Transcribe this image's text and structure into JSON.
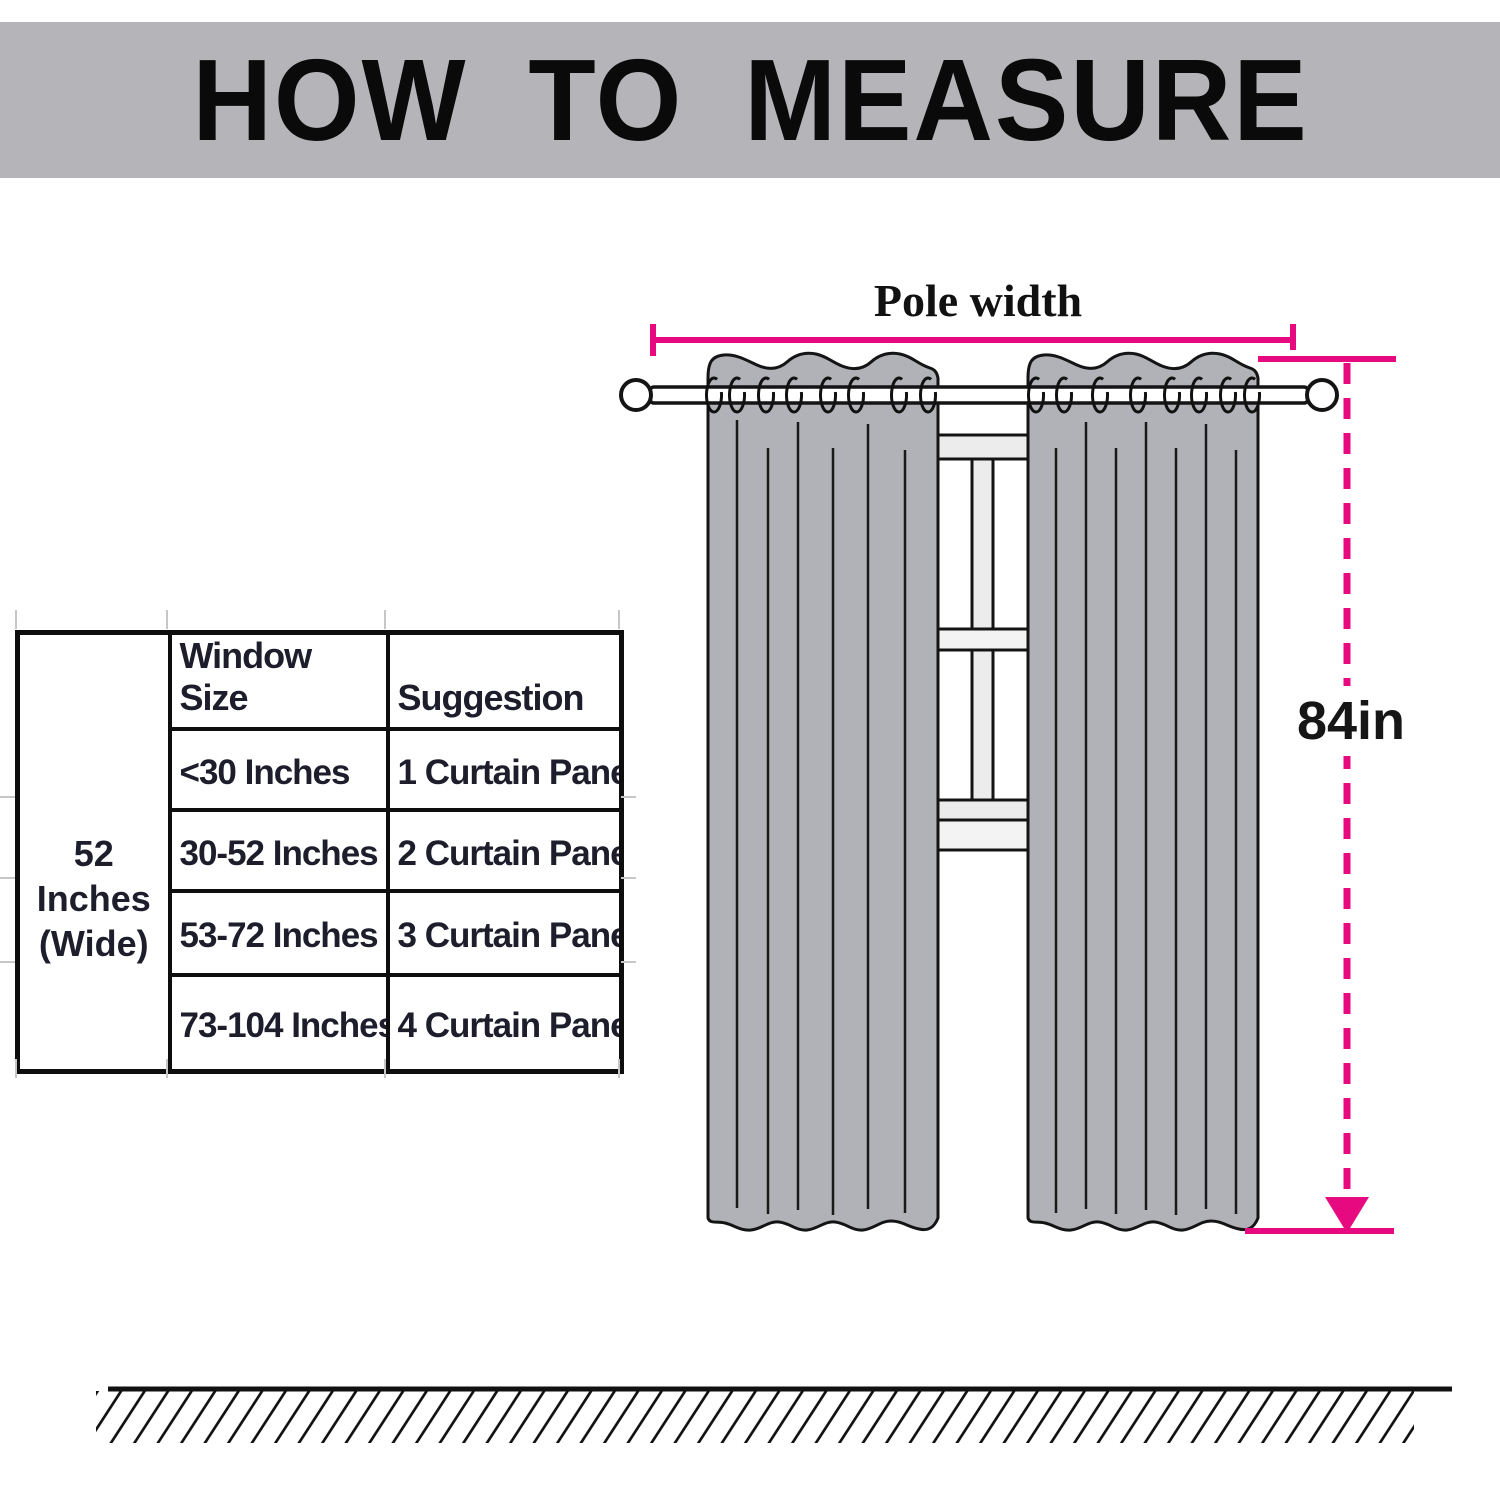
{
  "title": "HOW TO MEASURE",
  "diagram": {
    "pole_width_label": "Pole width",
    "height_label": "84in"
  },
  "table": {
    "col1": {
      "line1": "52 Inches",
      "line2": "(Wide)"
    },
    "headers": [
      "Window Size",
      "Suggestion"
    ],
    "rows": [
      {
        "window_size": "<30 Inches",
        "suggestion": "1 Curtain Panel"
      },
      {
        "window_size": "30-52 Inches",
        "suggestion": "2 Curtain Panel"
      },
      {
        "window_size": "53-72 Inches",
        "suggestion": "3 Curtain Panel"
      },
      {
        "window_size": "73-104 Inches",
        "suggestion": "4 Curtain Panel"
      }
    ]
  },
  "colors": {
    "accent": "#e7097f",
    "banner": "#b4b4b9",
    "curtain": "#b1b1b8",
    "frame_light": "#ececec",
    "table_text": "#1d1d2b"
  }
}
